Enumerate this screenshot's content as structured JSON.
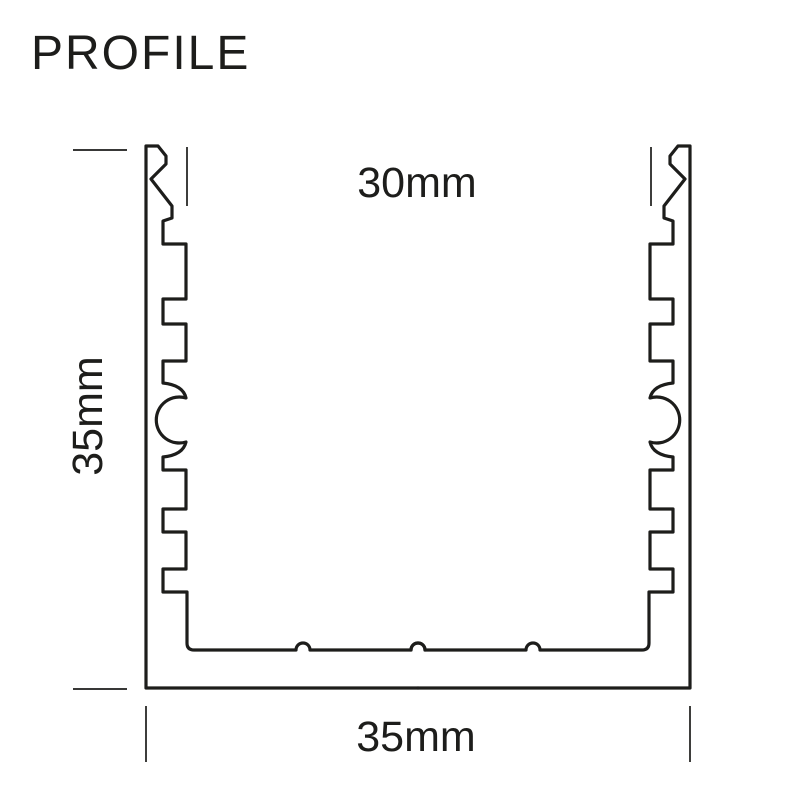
{
  "title": "PROFILE",
  "colors": {
    "line": "#1d1d1b",
    "background": "#ffffff"
  },
  "diagram": {
    "dimensions": {
      "inner_width": "30mm",
      "height": "35mm",
      "outer_width": "35mm"
    }
  }
}
